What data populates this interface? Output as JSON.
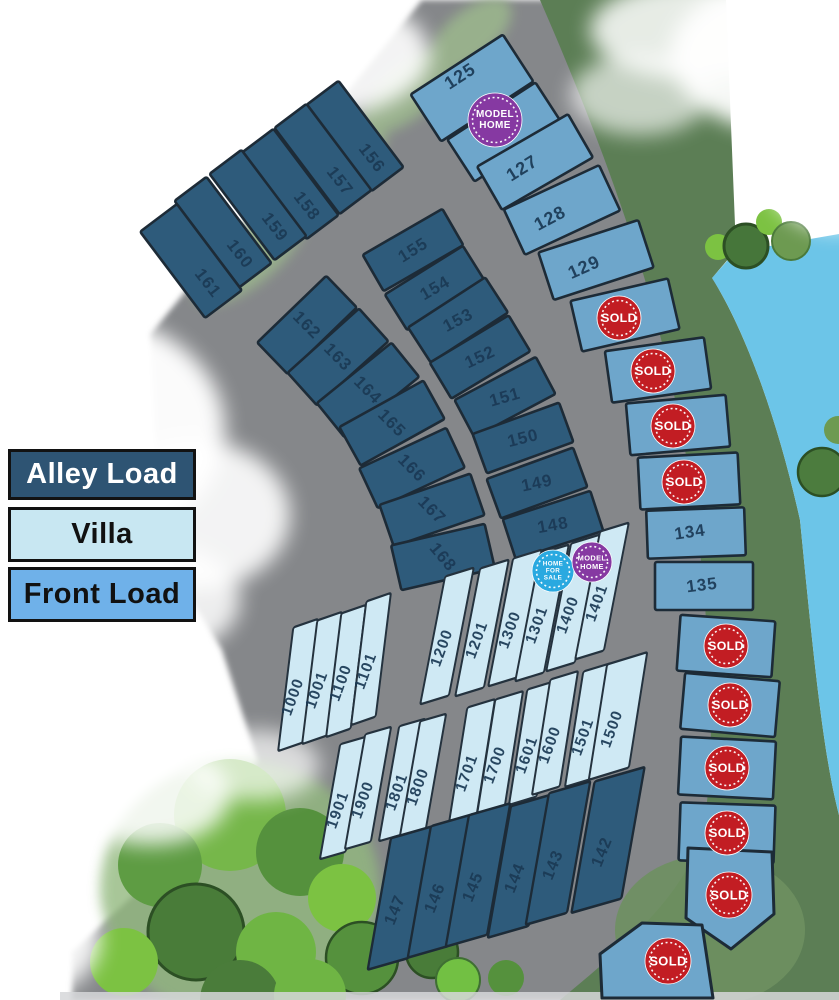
{
  "map_title": "community site plan",
  "legend": {
    "items": [
      {
        "label": "Alley Load",
        "fill": "#2e5473",
        "text": "#ffffff"
      },
      {
        "label": "Villa",
        "fill": "#c8e7f2",
        "text": "#111111"
      },
      {
        "label": "Front Load",
        "fill": "#6fb1e9",
        "text": "#111111"
      }
    ]
  },
  "lot_types": {
    "alley": {
      "fill": "#2e5b7b",
      "stroke": "#1d2b37"
    },
    "villa": {
      "fill": "#cfe9f4",
      "stroke": "#24323e"
    },
    "front": {
      "fill": "#6ea6cb",
      "stroke": "#1d2b37"
    }
  },
  "badge_defs": {
    "sold": {
      "color": "#c21d23",
      "lines": [
        "SOLD"
      ]
    },
    "model": {
      "color": "#8639a2",
      "lines": [
        "MODEL",
        "HOME"
      ]
    },
    "sale": {
      "color": "#2aa9e0",
      "lines": [
        "HOME",
        "FOR",
        "SALE"
      ]
    }
  },
  "lots": [
    {
      "n": "156",
      "t": "alley",
      "x": 355,
      "y": 136,
      "w": 40,
      "h": 108,
      "r": -37,
      "tx": 372,
      "ty": 158,
      "tr": 52,
      "fs": 17
    },
    {
      "n": "157",
      "t": "alley",
      "x": 323,
      "y": 159,
      "w": 40,
      "h": 108,
      "r": -37,
      "tx": 340,
      "ty": 181,
      "tr": 52,
      "fs": 17
    },
    {
      "n": "158",
      "t": "alley",
      "x": 290,
      "y": 184,
      "w": 40,
      "h": 108,
      "r": -37,
      "tx": 307,
      "ty": 206,
      "tr": 52,
      "fs": 17
    },
    {
      "n": "159",
      "t": "alley",
      "x": 258,
      "y": 205,
      "w": 40,
      "h": 108,
      "r": -37,
      "tx": 275,
      "ty": 227,
      "tr": 52,
      "fs": 17
    },
    {
      "n": "160",
      "t": "alley",
      "x": 223,
      "y": 232,
      "w": 40,
      "h": 108,
      "r": -37,
      "tx": 240,
      "ty": 254,
      "tr": 52,
      "fs": 17
    },
    {
      "n": "161",
      "t": "alley",
      "x": 191,
      "y": 261,
      "w": 46,
      "h": 108,
      "r": -37,
      "tx": 208,
      "ty": 283,
      "tr": 52,
      "fs": 17
    },
    {
      "n": "162",
      "t": "alley",
      "x": 307,
      "y": 325,
      "w": 44,
      "h": 96,
      "r": 46,
      "tx": 307,
      "ty": 325,
      "tr": 45,
      "fs": 17
    },
    {
      "n": "163",
      "t": "alley",
      "x": 338,
      "y": 357,
      "w": 44,
      "h": 96,
      "r": 48,
      "tx": 338,
      "ty": 357,
      "tr": 45,
      "fs": 17
    },
    {
      "n": "164",
      "t": "alley",
      "x": 368,
      "y": 390,
      "w": 44,
      "h": 96,
      "r": 51,
      "tx": 368,
      "ty": 390,
      "tr": 45,
      "fs": 17
    },
    {
      "n": "165",
      "t": "alley",
      "x": 392,
      "y": 423,
      "w": 44,
      "h": 96,
      "r": 61,
      "tx": 392,
      "ty": 423,
      "tr": 45,
      "fs": 17
    },
    {
      "n": "166",
      "t": "alley",
      "x": 412,
      "y": 468,
      "w": 44,
      "h": 96,
      "r": 65,
      "tx": 412,
      "ty": 468,
      "tr": 45,
      "fs": 17
    },
    {
      "n": "167",
      "t": "alley",
      "x": 432,
      "y": 510,
      "w": 44,
      "h": 96,
      "r": 71,
      "tx": 432,
      "ty": 510,
      "tr": 45,
      "fs": 17
    },
    {
      "n": "168",
      "t": "alley",
      "x": 443,
      "y": 557,
      "w": 46,
      "h": 96,
      "r": 77,
      "tx": 443,
      "ty": 557,
      "tr": 50,
      "fs": 17
    },
    {
      "n": "155",
      "t": "alley",
      "x": 413,
      "y": 250,
      "w": 42,
      "h": 92,
      "r": 60,
      "tx": 413,
      "ty": 250,
      "tr": -32,
      "fs": 17
    },
    {
      "n": "154",
      "t": "alley",
      "x": 435,
      "y": 288,
      "w": 42,
      "h": 92,
      "r": 58,
      "tx": 435,
      "ty": 288,
      "tr": -30,
      "fs": 17
    },
    {
      "n": "153",
      "t": "alley",
      "x": 458,
      "y": 320,
      "w": 42,
      "h": 92,
      "r": 57,
      "tx": 458,
      "ty": 320,
      "tr": -28,
      "fs": 17
    },
    {
      "n": "152",
      "t": "alley",
      "x": 480,
      "y": 357,
      "w": 42,
      "h": 92,
      "r": 59,
      "tx": 480,
      "ty": 357,
      "tr": -25,
      "fs": 17
    },
    {
      "n": "151",
      "t": "alley",
      "x": 505,
      "y": 397,
      "w": 42,
      "h": 92,
      "r": 62,
      "tx": 505,
      "ty": 397,
      "tr": -16,
      "fs": 17
    },
    {
      "n": "150",
      "t": "alley",
      "x": 523,
      "y": 438,
      "w": 42,
      "h": 92,
      "r": 70,
      "tx": 523,
      "ty": 438,
      "tr": -14,
      "fs": 17
    },
    {
      "n": "149",
      "t": "alley",
      "x": 537,
      "y": 483,
      "w": 42,
      "h": 92,
      "r": 70,
      "tx": 537,
      "ty": 483,
      "tr": -12,
      "fs": 17
    },
    {
      "n": "148",
      "t": "alley",
      "x": 553,
      "y": 525,
      "w": 42,
      "h": 92,
      "r": 72,
      "tx": 553,
      "ty": 525,
      "tr": -10,
      "fs": 17
    },
    {
      "n": "125",
      "t": "front",
      "x": 472,
      "y": 88,
      "w": 56,
      "h": 110,
      "r": 57,
      "tx": 460,
      "ty": 76,
      "tr": -33,
      "fs": 18
    },
    {
      "n": "",
      "t": "front",
      "x": 505,
      "y": 132,
      "w": 50,
      "h": 105,
      "r": 57,
      "b": "model",
      "bx": 495,
      "by": 120,
      "br": 27
    },
    {
      "n": "127",
      "t": "front",
      "x": 535,
      "y": 162,
      "w": 50,
      "h": 105,
      "r": 60,
      "tx": 522,
      "ty": 168,
      "tr": -32,
      "fs": 18
    },
    {
      "n": "128",
      "t": "front",
      "x": 562,
      "y": 210,
      "w": 50,
      "h": 105,
      "r": 65,
      "tx": 550,
      "ty": 218,
      "tr": -28,
      "fs": 18
    },
    {
      "n": "129",
      "t": "front",
      "x": 596,
      "y": 260,
      "w": 50,
      "h": 105,
      "r": 72,
      "tx": 584,
      "ty": 267,
      "tr": -24,
      "fs": 18
    },
    {
      "n": "",
      "t": "front",
      "x": 625,
      "y": 315,
      "w": 52,
      "h": 100,
      "r": 77,
      "b": "sold",
      "bx": 619,
      "by": 318,
      "br": 22
    },
    {
      "n": "",
      "t": "front",
      "x": 658,
      "y": 370,
      "w": 52,
      "h": 100,
      "r": 82,
      "b": "sold",
      "bx": 653,
      "by": 371,
      "br": 22
    },
    {
      "n": "",
      "t": "front",
      "x": 678,
      "y": 425,
      "w": 52,
      "h": 100,
      "r": 85,
      "b": "sold",
      "bx": 673,
      "by": 426,
      "br": 22
    },
    {
      "n": "",
      "t": "front",
      "x": 689,
      "y": 481,
      "w": 52,
      "h": 100,
      "r": 87,
      "b": "sold",
      "bx": 684,
      "by": 482,
      "br": 22
    },
    {
      "n": "134",
      "t": "front",
      "x": 696,
      "y": 533,
      "w": 48,
      "h": 98,
      "r": 88,
      "tx": 690,
      "ty": 532,
      "tr": -8,
      "fs": 17
    },
    {
      "n": "135",
      "t": "front",
      "x": 704,
      "y": 586,
      "w": 48,
      "h": 98,
      "r": 90,
      "tx": 702,
      "ty": 585,
      "tr": -7,
      "fs": 17
    },
    {
      "n": "",
      "t": "front",
      "x": 726,
      "y": 646,
      "w": 56,
      "h": 95,
      "r": 94,
      "b": "sold",
      "bx": 726,
      "by": 646,
      "br": 22
    },
    {
      "n": "",
      "t": "front",
      "x": 730,
      "y": 705,
      "w": 56,
      "h": 95,
      "r": 95,
      "b": "sold",
      "bx": 730,
      "by": 705,
      "br": 22
    },
    {
      "n": "",
      "t": "front",
      "x": 727,
      "y": 768,
      "w": 58,
      "h": 95,
      "r": 93,
      "b": "sold",
      "bx": 727,
      "by": 768,
      "br": 22
    },
    {
      "n": "",
      "t": "front",
      "x": 727,
      "y": 833,
      "w": 58,
      "h": 95,
      "r": 92,
      "b": "sold",
      "bx": 727,
      "by": 833,
      "br": 22
    },
    {
      "n": "",
      "t": "front",
      "pts": "688,848 772,852 774,914 731,949 686,918",
      "b": "sold",
      "bx": 729,
      "by": 895,
      "br": 23
    },
    {
      "n": "",
      "t": "front",
      "pts": "600,954 642,923 702,925 713,998 602,998",
      "b": "sold",
      "bx": 668,
      "by": 961,
      "br": 23
    },
    {
      "n": "1000",
      "t": "villa",
      "x": 298,
      "y": 685,
      "w": 26,
      "h": 112,
      "r": -19,
      "sk": -26,
      "tx": 293,
      "ty": 697,
      "tr": -70,
      "fs": 15.5
    },
    {
      "n": "1001",
      "t": "villa",
      "x": 322,
      "y": 678,
      "w": 26,
      "h": 112,
      "r": -19,
      "sk": -26,
      "tx": 317,
      "ty": 690,
      "tr": -70,
      "fs": 15.5
    },
    {
      "n": "1100",
      "t": "villa",
      "x": 346,
      "y": 671,
      "w": 26,
      "h": 112,
      "r": -19,
      "sk": -26,
      "tx": 341,
      "ty": 683,
      "tr": -70,
      "fs": 15.5
    },
    {
      "n": "1101",
      "t": "villa",
      "x": 371,
      "y": 659,
      "w": 26,
      "h": 112,
      "r": -19,
      "sk": -26,
      "tx": 366,
      "ty": 671,
      "tr": -70,
      "fs": 15.5
    },
    {
      "n": "1200",
      "t": "villa",
      "x": 447,
      "y": 636,
      "w": 30,
      "h": 115,
      "r": -17,
      "sk": -28,
      "tx": 442,
      "ty": 648,
      "tr": -70,
      "fs": 15.5
    },
    {
      "n": "1201",
      "t": "villa",
      "x": 482,
      "y": 628,
      "w": 30,
      "h": 115,
      "r": -17,
      "sk": -28,
      "tx": 477,
      "ty": 640,
      "tr": -70,
      "fs": 15.5
    },
    {
      "n": "1300",
      "t": "villa",
      "x": 515,
      "y": 618,
      "w": 30,
      "h": 115,
      "r": -17,
      "sk": -28,
      "tx": 510,
      "ty": 630,
      "tr": -70,
      "fs": 15.5
    },
    {
      "n": "1301",
      "t": "villa",
      "x": 542,
      "y": 613,
      "w": 30,
      "h": 115,
      "r": -17,
      "sk": -28,
      "tx": 537,
      "ty": 625,
      "tr": -70,
      "fs": 15.5
    },
    {
      "n": "1400",
      "t": "villa",
      "x": 573,
      "y": 603,
      "w": 30,
      "h": 115,
      "r": -17,
      "sk": -28,
      "tx": 568,
      "ty": 615,
      "tr": -70,
      "fs": 15.5,
      "b": "sale",
      "bx": 553,
      "by": 571,
      "br": 21
    },
    {
      "n": "1401",
      "t": "villa",
      "x": 602,
      "y": 591,
      "w": 30,
      "h": 115,
      "r": -17,
      "sk": -28,
      "tx": 597,
      "ty": 603,
      "tr": -70,
      "fs": 15.5,
      "b": "model",
      "bx": 592,
      "by": 562,
      "br": 20
    },
    {
      "n": "1901",
      "t": "villa",
      "x": 343,
      "y": 798,
      "w": 27,
      "h": 105,
      "r": -16,
      "sk": -26,
      "tx": 338,
      "ty": 810,
      "tr": -70,
      "fs": 15.5
    },
    {
      "n": "1900",
      "t": "villa",
      "x": 368,
      "y": 788,
      "w": 27,
      "h": 105,
      "r": -16,
      "sk": -26,
      "tx": 363,
      "ty": 800,
      "tr": -70,
      "fs": 15.5
    },
    {
      "n": "1801",
      "t": "villa",
      "x": 402,
      "y": 780,
      "w": 27,
      "h": 105,
      "r": -16,
      "sk": -26,
      "tx": 397,
      "ty": 792,
      "tr": -70,
      "fs": 15.5
    },
    {
      "n": "1800",
      "t": "villa",
      "x": 423,
      "y": 775,
      "w": 27,
      "h": 105,
      "r": -16,
      "sk": -26,
      "tx": 418,
      "ty": 787,
      "tr": -70,
      "fs": 15.5
    },
    {
      "n": "1701",
      "t": "villa",
      "x": 472,
      "y": 761,
      "w": 29,
      "h": 105,
      "r": -17,
      "sk": -26,
      "tx": 467,
      "ty": 773,
      "tr": -70,
      "fs": 15.5
    },
    {
      "n": "1700",
      "t": "villa",
      "x": 500,
      "y": 753,
      "w": 29,
      "h": 105,
      "r": -17,
      "sk": -26,
      "tx": 495,
      "ty": 765,
      "tr": -70,
      "fs": 15.5
    },
    {
      "n": "1601",
      "t": "villa",
      "x": 532,
      "y": 743,
      "w": 29,
      "h": 105,
      "r": -17,
      "sk": -26,
      "tx": 527,
      "ty": 755,
      "tr": -70,
      "fs": 15.5
    },
    {
      "n": "1600",
      "t": "villa",
      "x": 555,
      "y": 733,
      "w": 29,
      "h": 105,
      "r": -17,
      "sk": -26,
      "tx": 550,
      "ty": 745,
      "tr": -70,
      "fs": 15.5
    },
    {
      "n": "1501",
      "t": "villa",
      "x": 588,
      "y": 725,
      "w": 29,
      "h": 105,
      "r": -17,
      "sk": -26,
      "tx": 583,
      "ty": 737,
      "tr": -70,
      "fs": 15.5
    },
    {
      "n": "1500",
      "t": "villa",
      "x": 618,
      "y": 716,
      "w": 42,
      "h": 105,
      "r": -17,
      "sk": -26,
      "tx": 612,
      "ty": 729,
      "tr": -70,
      "fs": 15.5
    },
    {
      "n": "147",
      "t": "alley",
      "x": 400,
      "y": 898,
      "w": 43,
      "h": 120,
      "r": -16,
      "sk": -26,
      "tx": 395,
      "ty": 910,
      "tr": -68,
      "fs": 16.5
    },
    {
      "n": "146",
      "t": "alley",
      "x": 440,
      "y": 886,
      "w": 43,
      "h": 120,
      "r": -16,
      "sk": -26,
      "tx": 435,
      "ty": 898,
      "tr": -68,
      "fs": 16.5
    },
    {
      "n": "145",
      "t": "alley",
      "x": 478,
      "y": 875,
      "w": 43,
      "h": 120,
      "r": -16,
      "sk": -26,
      "tx": 473,
      "ty": 887,
      "tr": -68,
      "fs": 16.5
    },
    {
      "n": "144",
      "t": "alley",
      "x": 520,
      "y": 866,
      "w": 43,
      "h": 120,
      "r": -16,
      "sk": -26,
      "tx": 515,
      "ty": 878,
      "tr": -68,
      "fs": 16.5
    },
    {
      "n": "143",
      "t": "alley",
      "x": 558,
      "y": 853,
      "w": 43,
      "h": 120,
      "r": -16,
      "sk": -26,
      "tx": 553,
      "ty": 865,
      "tr": -68,
      "fs": 16.5
    },
    {
      "n": "142",
      "t": "alley",
      "x": 608,
      "y": 840,
      "w": 52,
      "h": 120,
      "r": -16,
      "sk": -26,
      "tx": 602,
      "ty": 852,
      "tr": -68,
      "fs": 16.5
    }
  ]
}
